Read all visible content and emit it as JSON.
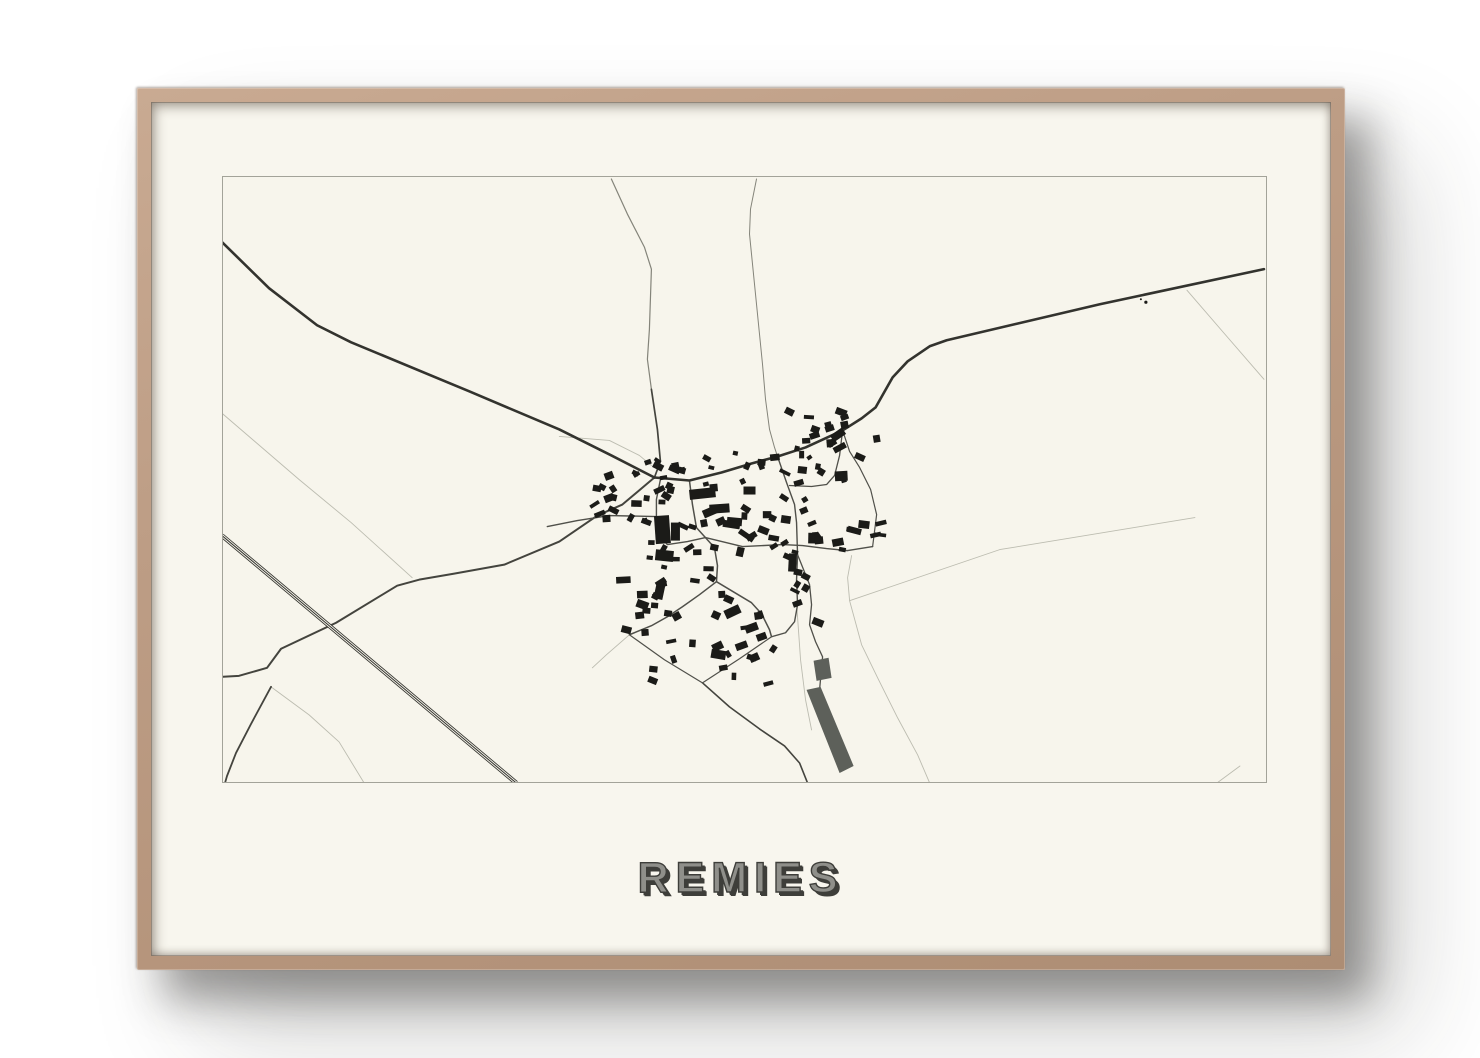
{
  "poster": {
    "title": "REMIES"
  },
  "colors": {
    "paper": "#f7f5ec",
    "map_border": "#a3a399",
    "road_dark": "#33332e",
    "road_med": "#44443e",
    "road_village": "#50504a",
    "road_thin": "#84847a",
    "road_faint": "#bcbcb0",
    "building": "#1b1b18",
    "field_fill": "#5d605a"
  },
  "map": {
    "viewBox": "224 178 1042 604",
    "roads": [
      {
        "name": "faint-ne-branch",
        "cls": "faint",
        "w": 0.9,
        "pts": [
          [
            1187,
            291
          ],
          [
            1225,
            335
          ],
          [
            1264,
            380
          ]
        ]
      },
      {
        "name": "faint-east-field",
        "cls": "faint",
        "w": 0.9,
        "pts": [
          [
            850,
            601
          ],
          [
            1000,
            550
          ],
          [
            1195,
            518
          ]
        ]
      },
      {
        "name": "faint-se-track",
        "cls": "faint",
        "w": 0.9,
        "pts": [
          [
            852,
            556
          ],
          [
            848,
            578
          ],
          [
            850,
            601
          ],
          [
            862,
            645
          ],
          [
            878,
            678
          ],
          [
            898,
            718
          ],
          [
            918,
            755
          ],
          [
            930,
            783
          ]
        ]
      },
      {
        "name": "faint-corner-br",
        "cls": "faint",
        "w": 0.9,
        "pts": [
          [
            1217,
            783
          ],
          [
            1240,
            766
          ]
        ]
      },
      {
        "name": "faint-west-track",
        "cls": "faint",
        "w": 0.9,
        "pts": [
          [
            222,
            413
          ],
          [
            300,
            480
          ],
          [
            352,
            523
          ],
          [
            413,
            578
          ]
        ]
      },
      {
        "name": "faint-nw-boundary",
        "cls": "faint",
        "w": 0.9,
        "pts": [
          [
            560,
            437
          ],
          [
            610,
            441
          ],
          [
            640,
            456
          ],
          [
            652,
            466
          ]
        ]
      },
      {
        "name": "faint-sw-branch",
        "cls": "faint",
        "w": 0.9,
        "pts": [
          [
            272,
            687
          ],
          [
            310,
            715
          ],
          [
            340,
            742
          ],
          [
            365,
            783
          ]
        ]
      },
      {
        "name": "faint-s-village",
        "cls": "faint",
        "w": 0.9,
        "pts": [
          [
            630,
            635
          ],
          [
            607,
            655
          ],
          [
            593,
            668
          ]
        ]
      },
      {
        "name": "faint-strip-track",
        "cls": "faint",
        "w": 0.9,
        "pts": [
          [
            797,
            603
          ],
          [
            801,
            660
          ],
          [
            806,
            700
          ],
          [
            812,
            730
          ]
        ]
      },
      {
        "name": "road-north-upper",
        "cls": "thin",
        "w": 1.2,
        "pts": [
          [
            612,
            180
          ],
          [
            628,
            215
          ],
          [
            645,
            248
          ],
          [
            652,
            270
          ],
          [
            650,
            330
          ],
          [
            648,
            360
          ],
          [
            652,
            390
          ]
        ]
      },
      {
        "name": "road-north-lower",
        "cls": "med",
        "w": 1.7,
        "pts": [
          [
            652,
            390
          ],
          [
            658,
            430
          ],
          [
            661,
            462
          ],
          [
            655,
            478
          ]
        ]
      },
      {
        "name": "road-north2",
        "cls": "thin",
        "w": 1.0,
        "pts": [
          [
            757,
            180
          ],
          [
            751,
            210
          ],
          [
            750,
            235
          ],
          [
            755,
            285
          ],
          [
            760,
            335
          ],
          [
            763,
            365
          ],
          [
            766,
            400
          ],
          [
            770,
            430
          ],
          [
            775,
            448
          ],
          [
            778,
            457
          ]
        ]
      },
      {
        "name": "road-sw",
        "cls": "med",
        "w": 2.0,
        "pts": [
          [
            655,
            478
          ],
          [
            623,
            505
          ],
          [
            598,
            516
          ],
          [
            560,
            542
          ],
          [
            505,
            565
          ],
          [
            455,
            574
          ],
          [
            420,
            580
          ],
          [
            398,
            586
          ],
          [
            337,
            623
          ],
          [
            282,
            649
          ],
          [
            268,
            668
          ],
          [
            240,
            676
          ],
          [
            222,
            677
          ]
        ]
      },
      {
        "name": "road-sw-branch",
        "cls": "med",
        "w": 1.8,
        "pts": [
          [
            272,
            687
          ],
          [
            252,
            724
          ],
          [
            237,
            753
          ],
          [
            228,
            776
          ],
          [
            226,
            783
          ]
        ]
      },
      {
        "name": "road-south-exit",
        "cls": "med",
        "w": 1.6,
        "pts": [
          [
            703,
            683
          ],
          [
            730,
            707
          ],
          [
            760,
            729
          ],
          [
            785,
            746
          ],
          [
            800,
            763
          ],
          [
            808,
            783
          ]
        ]
      },
      {
        "name": "street-s1",
        "cls": "vil",
        "w": 1.5,
        "pts": [
          [
            690,
            481
          ],
          [
            693,
            505
          ],
          [
            697,
            528
          ],
          [
            706,
            538
          ],
          [
            715,
            548
          ],
          [
            718,
            566
          ],
          [
            717,
            582
          ]
        ]
      },
      {
        "name": "street-s2",
        "cls": "vil",
        "w": 1.4,
        "pts": [
          [
            661,
            480
          ],
          [
            657,
            500
          ],
          [
            657,
            517
          ],
          [
            660,
            536
          ],
          [
            668,
            545
          ],
          [
            688,
            542
          ],
          [
            706,
            538
          ]
        ]
      },
      {
        "name": "street-west",
        "cls": "vil",
        "w": 1.4,
        "pts": [
          [
            657,
            517
          ],
          [
            610,
            516
          ],
          [
            578,
            521
          ],
          [
            548,
            527
          ]
        ]
      },
      {
        "name": "street-east-west",
        "cls": "vil",
        "w": 1.4,
        "pts": [
          [
            706,
            538
          ],
          [
            743,
            547
          ],
          [
            783,
            545
          ],
          [
            803,
            546
          ],
          [
            827,
            549
          ],
          [
            848,
            551
          ],
          [
            873,
            547
          ]
        ]
      },
      {
        "name": "street-sw-diag",
        "cls": "vil",
        "w": 1.5,
        "pts": [
          [
            717,
            582
          ],
          [
            700,
            595
          ],
          [
            683,
            607
          ],
          [
            668,
            617
          ],
          [
            652,
            626
          ],
          [
            630,
            635
          ]
        ]
      },
      {
        "name": "street-se-diag",
        "cls": "vil",
        "w": 1.5,
        "pts": [
          [
            717,
            582
          ],
          [
            737,
            594
          ],
          [
            752,
            603
          ],
          [
            762,
            614
          ],
          [
            770,
            630
          ],
          [
            772,
            637
          ]
        ]
      },
      {
        "name": "parcel-west-side",
        "cls": "vil",
        "w": 1.2,
        "pts": [
          [
            630,
            635
          ],
          [
            665,
            660
          ],
          [
            703,
            683
          ]
        ]
      },
      {
        "name": "parcel-east-side",
        "cls": "vil",
        "w": 1.2,
        "pts": [
          [
            703,
            683
          ],
          [
            740,
            659
          ],
          [
            772,
            637
          ]
        ]
      },
      {
        "name": "street-east-ns",
        "cls": "vil",
        "w": 1.4,
        "pts": [
          [
            778,
            457
          ],
          [
            787,
            483
          ],
          [
            795,
            505
          ],
          [
            797,
            523
          ],
          [
            798,
            555
          ],
          [
            797,
            580
          ],
          [
            798,
            605
          ],
          [
            795,
            622
          ],
          [
            786,
            633
          ],
          [
            772,
            637
          ]
        ]
      },
      {
        "name": "street-east-ext",
        "cls": "vil",
        "w": 1.3,
        "pts": [
          [
            798,
            555
          ],
          [
            810,
            585
          ],
          [
            812,
            605
          ],
          [
            810,
            625
          ],
          [
            816,
            642
          ],
          [
            823,
            657
          ],
          [
            820,
            690
          ]
        ]
      },
      {
        "name": "street-ne-loop1",
        "cls": "vil",
        "w": 1.3,
        "pts": [
          [
            843,
            431
          ],
          [
            840,
            456
          ],
          [
            835,
            476
          ],
          [
            827,
            485
          ],
          [
            812,
            487
          ],
          [
            790,
            486
          ]
        ]
      },
      {
        "name": "street-ne-loop2",
        "cls": "vil",
        "w": 1.2,
        "pts": [
          [
            873,
            547
          ],
          [
            877,
            515
          ],
          [
            871,
            490
          ],
          [
            860,
            468
          ],
          [
            850,
            452
          ],
          [
            843,
            431
          ]
        ]
      },
      {
        "name": "highway-northwest",
        "cls": "dark",
        "w": 2.6,
        "pts": [
          [
            222,
            242
          ],
          [
            270,
            289
          ],
          [
            318,
            326
          ],
          [
            352,
            343
          ],
          [
            470,
            392
          ],
          [
            560,
            430
          ],
          [
            612,
            456
          ],
          [
            655,
            478
          ]
        ]
      },
      {
        "name": "highway-east",
        "cls": "dark",
        "w": 2.6,
        "pts": [
          [
            655,
            478
          ],
          [
            690,
            481
          ],
          [
            722,
            473
          ],
          [
            752,
            464
          ],
          [
            778,
            457
          ],
          [
            806,
            448
          ],
          [
            843,
            431
          ],
          [
            862,
            419
          ],
          [
            876,
            408
          ],
          [
            893,
            378
          ],
          [
            908,
            362
          ],
          [
            930,
            347
          ],
          [
            947,
            341
          ],
          [
            1100,
            305
          ],
          [
            1264,
            270
          ]
        ]
      }
    ],
    "railway": {
      "name": "railway-line",
      "pts": [
        [
          223,
          536
        ],
        [
          517,
          783
        ]
      ],
      "outer_w": 4.6,
      "gap_w": 2.9,
      "inner_w": 1.0
    },
    "polygons": [
      {
        "name": "field-patch-small",
        "pts": [
          [
            814,
            661
          ],
          [
            829,
            658
          ],
          [
            832,
            678
          ],
          [
            817,
            681
          ]
        ]
      },
      {
        "name": "field-strip-long",
        "pts": [
          [
            807,
            690
          ],
          [
            821,
            687
          ],
          [
            854,
            766
          ],
          [
            840,
            773
          ]
        ]
      }
    ],
    "dots": [
      [
        1146,
        303,
        1.6
      ],
      [
        1141,
        300,
        1.0
      ]
    ],
    "building_clusters": [
      [
        595,
        487,
        70,
        38,
        13
      ],
      [
        608,
        452,
        172,
        33,
        20
      ],
      [
        788,
        408,
        95,
        50,
        13
      ],
      [
        660,
        485,
        115,
        44,
        15
      ],
      [
        640,
        518,
        50,
        52,
        8
      ],
      [
        692,
        528,
        108,
        42,
        11
      ],
      [
        779,
        458,
        40,
        168,
        17
      ],
      [
        816,
        512,
        66,
        46,
        10
      ],
      [
        622,
        572,
        105,
        66,
        15
      ],
      [
        718,
        586,
        90,
        72,
        12
      ],
      [
        645,
        640,
        130,
        46,
        8
      ],
      [
        796,
        415,
        52,
        72,
        8
      ]
    ],
    "buildings_explicit": [
      [
        703,
        494,
        26,
        10,
        -6
      ],
      [
        720,
        509,
        20,
        9,
        -4
      ],
      [
        735,
        522,
        15,
        8,
        5
      ],
      [
        750,
        491,
        12,
        8,
        0
      ],
      [
        663,
        530,
        15,
        28,
        -4
      ],
      [
        676,
        532,
        9,
        18,
        0
      ],
      [
        665,
        556,
        18,
        11,
        6
      ],
      [
        793,
        563,
        8,
        18,
        3
      ],
      [
        733,
        612,
        16,
        9,
        -25
      ],
      [
        752,
        628,
        13,
        8,
        -20
      ],
      [
        762,
        637,
        10,
        7,
        -20
      ],
      [
        742,
        646,
        12,
        7,
        -20
      ],
      [
        660,
        592,
        9,
        15,
        12
      ],
      [
        643,
        605,
        12,
        8,
        20
      ],
      [
        627,
        630,
        10,
        7,
        15
      ],
      [
        815,
        436,
        10,
        6,
        -18
      ],
      [
        830,
        429,
        9,
        6,
        -18
      ],
      [
        845,
        418,
        8,
        5,
        -20
      ]
    ],
    "seed": 42
  }
}
